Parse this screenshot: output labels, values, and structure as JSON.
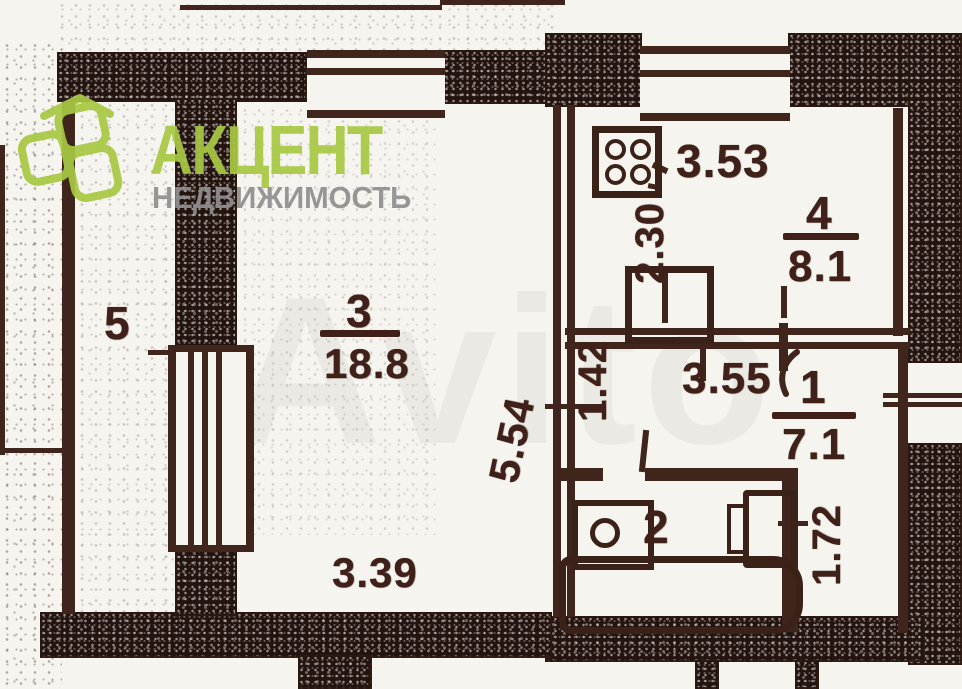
{
  "page": {
    "background": "#f6f4ef",
    "kind": "scanned apartment floor plan"
  },
  "watermark": {
    "text": "Avito"
  },
  "logo": {
    "brand": "АКЦЕНТ",
    "tagline": "НЕДВИЖИМОСТЬ",
    "brand_color": "#a8c843",
    "tagline_color": "#8f8f8f",
    "icon": "stacked-glass-panels-icon"
  },
  "plan": {
    "line_color": "#40251d",
    "wall_fill": "#241410",
    "rooms": [
      {
        "key": "balcony",
        "number": "5"
      },
      {
        "key": "living-room",
        "number": "3",
        "area": "18.8",
        "dims": [
          "3.39",
          "5.54"
        ]
      },
      {
        "key": "kitchen",
        "number": "4",
        "area": "8.1",
        "dims": [
          "3.53",
          "2.30"
        ]
      },
      {
        "key": "hallway",
        "number": "1",
        "area": "7.1",
        "dims": [
          "3.55",
          "1.42",
          "1.72"
        ]
      },
      {
        "key": "bathroom",
        "number": "2"
      }
    ],
    "labels": {
      "room5": "5",
      "room3": "3",
      "room3_area": "18.8",
      "room4": "4",
      "room4_area": "8.1",
      "room1": "1",
      "room1_area": "7.1",
      "room2": "2",
      "dim_339": "3.39",
      "dim_554": "5.54",
      "dim_142": "1.42",
      "dim_355": "3.55",
      "dim_172": "1.72",
      "dim_353": "3.53",
      "dim_230": "2.30"
    },
    "fixtures": [
      "stove-icon",
      "sink-icon",
      "toilet-icon",
      "bathtub-icon",
      "window-symbol",
      "door-arc"
    ]
  }
}
